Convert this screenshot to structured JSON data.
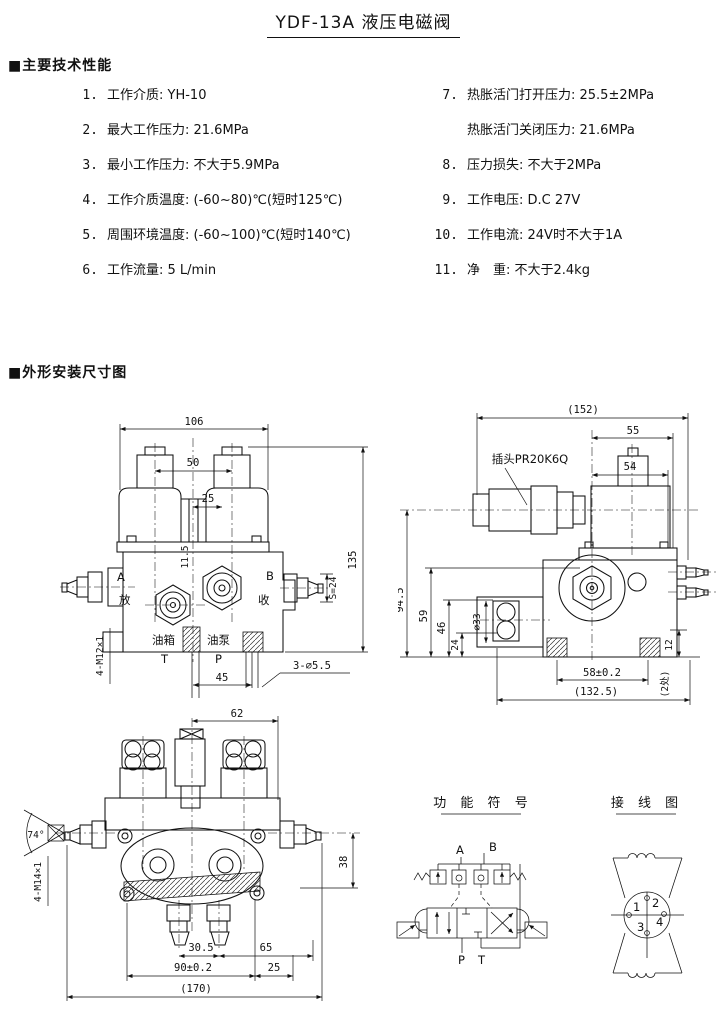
{
  "page": {
    "title": "YDF-13A 液压电磁阀"
  },
  "specs": {
    "header": "■主要技术性能",
    "left": [
      {
        "num": "1.",
        "text": "工作介质: YH-10"
      },
      {
        "num": "2.",
        "text": "最大工作压力: 21.6MPa"
      },
      {
        "num": "3.",
        "text": "最小工作压力: 不大于5.9MPa"
      },
      {
        "num": "4.",
        "text": "工作介质温度: (-60~80)℃(短时125℃)"
      },
      {
        "num": "5.",
        "text": "周围环境温度: (-60~100)℃(短时140℃)"
      },
      {
        "num": "6.",
        "text": "工作流量: 5 L/min"
      }
    ],
    "right": [
      {
        "num": "7.",
        "text": "热胀活门打开压力: 25.5±2MPa"
      },
      {
        "num": "",
        "text": "热胀活门关闭压力: 21.6MPa"
      },
      {
        "num": "8.",
        "text": "压力损失: 不大于2MPa"
      },
      {
        "num": "9.",
        "text": "工作电压: D.C 27V"
      },
      {
        "num": "10.",
        "text": "工作电流: 24V时不大于1A"
      },
      {
        "num": "11.",
        "text": "净　重: 不大于2.4kg"
      }
    ]
  },
  "drawings": {
    "header": "■外形安装尺寸图",
    "front": {
      "d106": "106",
      "d50": "50",
      "d25": "25",
      "d11_5": "11.5",
      "d135": "135",
      "s24": "S=24",
      "d45": "45",
      "d3_55": "3-∅5.5",
      "thread": "4-M12×1",
      "a": "A",
      "b": "B",
      "fang": "放",
      "shou": "收",
      "tank": "油箱",
      "t": "T",
      "pump": "油泵",
      "p": "P"
    },
    "side": {
      "d152": "(152)",
      "d55": "55",
      "d54": "54",
      "plug": "插头PR20K6Q",
      "d94_5": "94.5",
      "d59": "59",
      "d46": "46",
      "d24": "24",
      "d33": "∅33",
      "d58": "58±0.2",
      "d132_5": "(132.5)",
      "d12": "12",
      "places": "(2处)"
    },
    "bottom": {
      "d62": "62",
      "angle": "74°",
      "thread": "4-M14×1",
      "d38": "38",
      "d30_5": "30.5",
      "d65": "65",
      "d90": "90±0.2",
      "d25": "25",
      "d170": "(170)"
    },
    "symbol": {
      "title": "功 能 符 号",
      "a": "A",
      "b": "B",
      "p": "P",
      "t": "T"
    },
    "wiring": {
      "title": "接 线 图",
      "p1": "1",
      "p2": "2",
      "p3": "3",
      "p4": "4"
    }
  }
}
